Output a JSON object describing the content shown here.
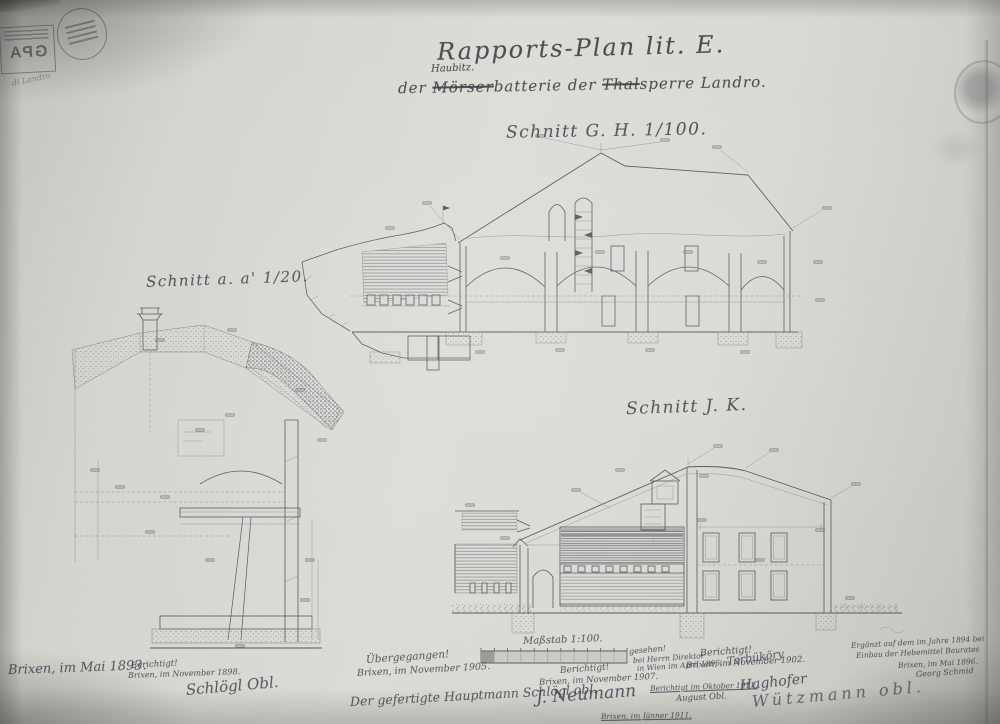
{
  "colors": {
    "paper": "#d9d8d3",
    "ink": "#4b4b52",
    "faint_ink": "#8d8d93",
    "stamp_ink": "#5a5a62"
  },
  "title": {
    "line1": "Rapports-Plan lit. E.",
    "inserted": "Haubitz.",
    "part1": "der ",
    "struck1": "Mörser",
    "part2": "batterie der ",
    "struck2": "Thal",
    "part3": "sperre Landro."
  },
  "section_labels": {
    "aa": "Schnitt a. a' 1/20.",
    "gh": "Schnitt G. H. 1/100.",
    "jk": "Schnitt J. K."
  },
  "stamps": {
    "gpa": "GPA"
  },
  "scalebar": {
    "label": "Maßstab 1:100."
  },
  "annotations": [
    {
      "text": "Brixen, im Mai 1893."
    },
    {
      "text": "Berichtigt!"
    },
    {
      "text": "Brixen, im November 1898."
    },
    {
      "text": "Schlögl Obl."
    },
    {
      "text": "Übergegangen!"
    },
    {
      "text": "Brixen, im November 1905."
    },
    {
      "text": "Der gefertigte Hauptmann Schlögl obl."
    },
    {
      "text": "gesehen!"
    },
    {
      "text": "bei Herrn Direktor"
    },
    {
      "text": "in Wien im April 1896."
    },
    {
      "text": "Tarbüköry"
    },
    {
      "text": "Berichtigt im Oktober 1911."
    },
    {
      "text": "August Obl."
    },
    {
      "text": "Berichtigt!"
    },
    {
      "text": "Brixen, im November 1907."
    },
    {
      "text": "J. Neumann"
    },
    {
      "text": "Brixen, im Jänner 1911."
    },
    {
      "text": "Berichtigt!"
    },
    {
      "text": "Brixen, im November 1902."
    },
    {
      "text": "Haghofer"
    },
    {
      "text": "Wützmann obl."
    },
    {
      "text": "Ergänzt auf dem im Jahre 1894 bei"
    },
    {
      "text": "Einbau der Hebemittel Baurates"
    },
    {
      "text": "Brixen, im Mai 1896."
    },
    {
      "text": "Georg Schmid"
    },
    {
      "text": "di Landro"
    }
  ]
}
